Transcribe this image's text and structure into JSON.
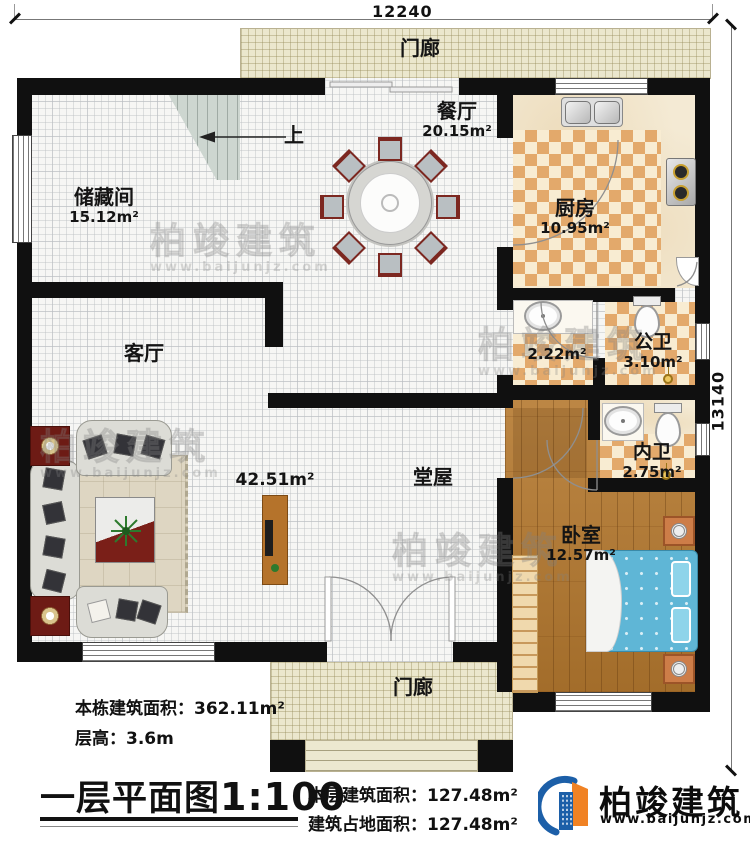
{
  "dims": {
    "top": "12240",
    "right": "13140"
  },
  "rooms": {
    "porch_top": {
      "name": "门廊"
    },
    "storage": {
      "name": "储藏间",
      "area": "15.12m²"
    },
    "dining": {
      "name": "餐厅",
      "area": "20.15m²"
    },
    "kitchen": {
      "name": "厨房",
      "area": "10.95m²"
    },
    "living": {
      "name": "客厅"
    },
    "wash": {
      "area": "2.22m²"
    },
    "public_wc": {
      "name": "公卫",
      "area": "3.10m²"
    },
    "private_wc": {
      "name": "内卫",
      "area": "2.75m²"
    },
    "hall": {
      "name": "堂屋",
      "area": "42.51m²"
    },
    "bedroom": {
      "name": "卧室",
      "area": "12.57m²"
    },
    "porch_bottom": {
      "name": "门廊"
    },
    "stair": {
      "up": "上"
    }
  },
  "footer": {
    "total_label": "本栋建筑面积：",
    "total_value": "362.11m²",
    "height_label": "层高：",
    "height_value": "3.6m",
    "title": "一层平面图",
    "scale": "1:100",
    "floor_label": "本层建筑面积：",
    "floor_value": "127.48m²",
    "footprint_label": "建筑占地面积：",
    "footprint_value": "127.48m²"
  },
  "brand": {
    "name": "柏竣建筑",
    "website": "www.baijunjz.com"
  },
  "watermark": {
    "name": "柏竣建筑",
    "website": "www.baijunjz.com"
  },
  "colors": {
    "wall": "#101010",
    "brand_blue": "#1c5fa8",
    "brand_orange": "#f08224",
    "porch_floor": "#ebe7cd",
    "kitchen_tile": "#e3a96b",
    "wood_floor": "#b5792f",
    "bed": "#5fb6d6",
    "stair": "#cdd6d0"
  }
}
